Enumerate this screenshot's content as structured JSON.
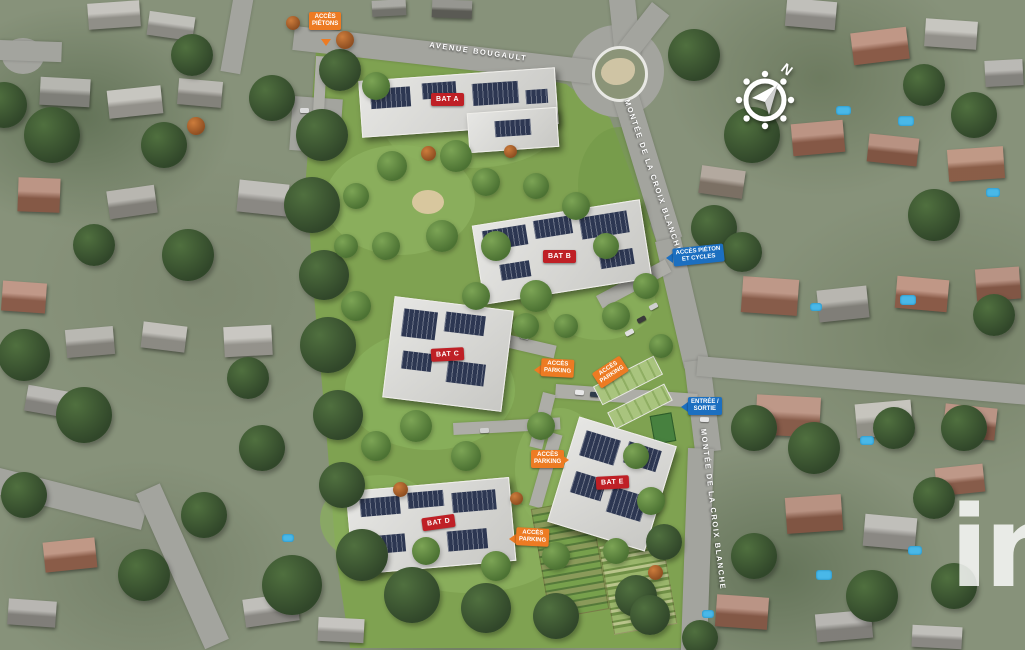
{
  "streets": {
    "avenue": "AVENUE BOUGAULT",
    "montee_upper": "MONTÉE DE LA CROIX BLANCHE",
    "montee_lower": "MONTÉE DE LA CROIX BLANCHE"
  },
  "buildings": {
    "a": "BAT A",
    "b": "BAT B",
    "c": "BAT C",
    "d": "BAT D",
    "e": "BAT E"
  },
  "access": {
    "pietons_top": "ACCÈS\nPIÉTONS",
    "pieton_cycles": "ACCÈS PIÉTON\nET CYCLES",
    "parking_west": "ACCÈS\nPARKING",
    "parking_carport": "ACCÈS\nPARKING",
    "entree_sortie": "ENTRÉE /\nSORTIE",
    "parking_center": "ACCÈS\nPARKING",
    "parking_south": "ACCÈS\nPARKING"
  },
  "compass": {
    "north": "N"
  },
  "watermark": {
    "text": "in"
  },
  "colors": {
    "building_label_red": "#bf2026",
    "access_orange": "#ed7b23",
    "access_blue": "#1c6fc0",
    "parcel_green": "#7fa251",
    "solar_panel_navy": "#2d3752"
  }
}
